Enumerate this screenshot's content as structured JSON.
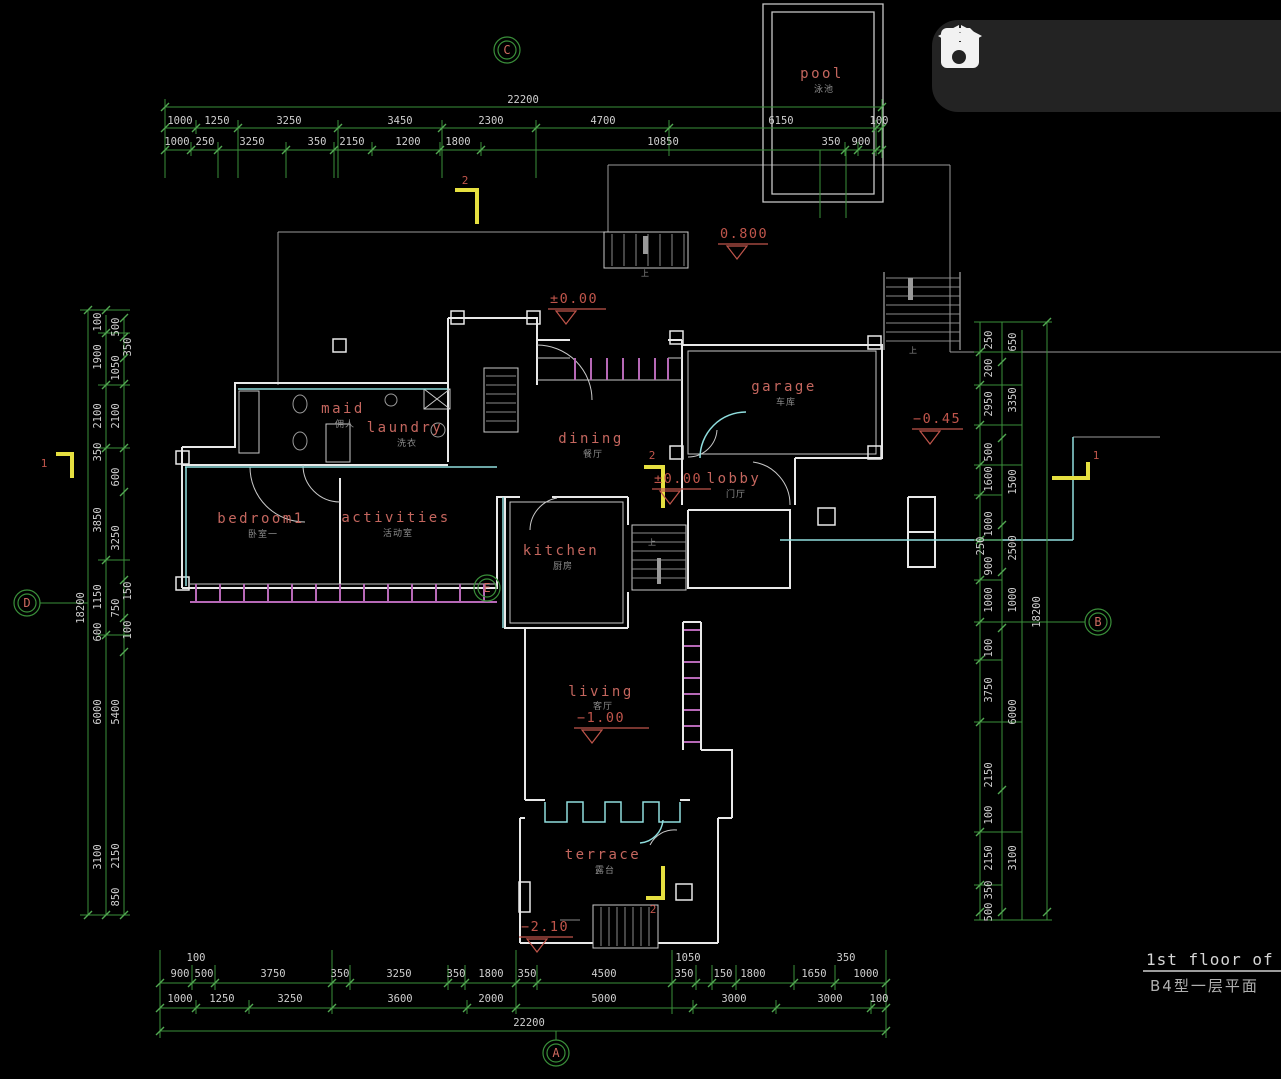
{
  "toolbar": {
    "buttons": [
      {
        "icon": "save-icon"
      },
      {
        "icon": "undo-icon"
      },
      {
        "icon": "redo-icon"
      }
    ]
  },
  "title_block": {
    "en": "1st floor of B",
    "cn": "B4型一层平面"
  },
  "grid_bubbles": {
    "top": "C",
    "bottom": "A",
    "left": "D",
    "right": "B",
    "inner": "E"
  },
  "rooms": {
    "pool": {
      "en": "pool",
      "cn": "泳池"
    },
    "maid": {
      "en": "maid",
      "cn": "佣人"
    },
    "laundry": {
      "en": "laundry",
      "cn": "洗衣"
    },
    "dining": {
      "en": "dining",
      "cn": "餐厅"
    },
    "garage": {
      "en": "garage",
      "cn": "车库"
    },
    "lobby": {
      "en": "lobby",
      "cn": "门厅"
    },
    "bedroom1": {
      "en": "bedroom1",
      "cn": "卧室一"
    },
    "activities": {
      "en": "activities",
      "cn": "活动室"
    },
    "kitchen": {
      "en": "kitchen",
      "cn": "厨房"
    },
    "living": {
      "en": "living",
      "cn": "客厅"
    },
    "terrace": {
      "en": "terrace",
      "cn": "露台"
    }
  },
  "elevations": {
    "upper": "0.800",
    "entry": "±0.00",
    "garage_out": "−0.45",
    "lobby": "±0.00",
    "living": "−1.00",
    "terrace": "−2.10"
  },
  "section_marks": {
    "top": "2",
    "mid": "2",
    "terrace": "2",
    "left": "1",
    "right": "1"
  },
  "stair_notes": [
    "上",
    "上",
    "上"
  ],
  "dims": {
    "top": {
      "total": "22200",
      "r1": [
        "1000",
        "1250",
        "3250",
        "3450",
        "2300",
        "4700",
        "6150",
        "100"
      ],
      "r2": [
        "1000",
        "250",
        "3250",
        "350",
        "2150",
        "1200",
        "1800",
        "10850",
        "350",
        "900"
      ]
    },
    "bottom": {
      "total": "22200",
      "small": [
        "100",
        "1050",
        "350"
      ],
      "r1": [
        "900",
        "500",
        "3750",
        "350",
        "3250",
        "350",
        "1800",
        "350",
        "4500",
        "350",
        "150",
        "1800",
        "1650",
        "1000"
      ],
      "r2": [
        "1000",
        "1250",
        "3250",
        "3600",
        "2000",
        "5000",
        "3000",
        "3000",
        "100"
      ]
    },
    "left": {
      "total": "18200",
      "colA": [
        "100",
        "1900",
        "2100",
        "350",
        "3850",
        "1150",
        "600",
        "6000",
        "3100"
      ],
      "colB": [
        "500",
        "350",
        "1050",
        "2100",
        "600",
        "3250",
        "150",
        "750",
        "100",
        "5400",
        "2150",
        "850"
      ]
    },
    "right": {
      "total": "18200",
      "colA": [
        "250",
        "200",
        "2950",
        "500",
        "1600",
        "1000",
        "250",
        "900",
        "1000",
        "100",
        "3750",
        "2150",
        "100",
        "2150",
        "350",
        "500"
      ],
      "colB": [
        "650",
        "3350",
        "1500",
        "2500",
        "1000",
        "6000",
        "3100"
      ]
    }
  },
  "colors": {
    "dim_line": "#3a8f3a",
    "wall": "#e8e8e8",
    "accent_cyan": "#8fdede",
    "window_magenta": "#b668b6",
    "label_red": "#c4665e",
    "section_yellow": "#e6e040",
    "toolbar_bg": "#232323"
  }
}
